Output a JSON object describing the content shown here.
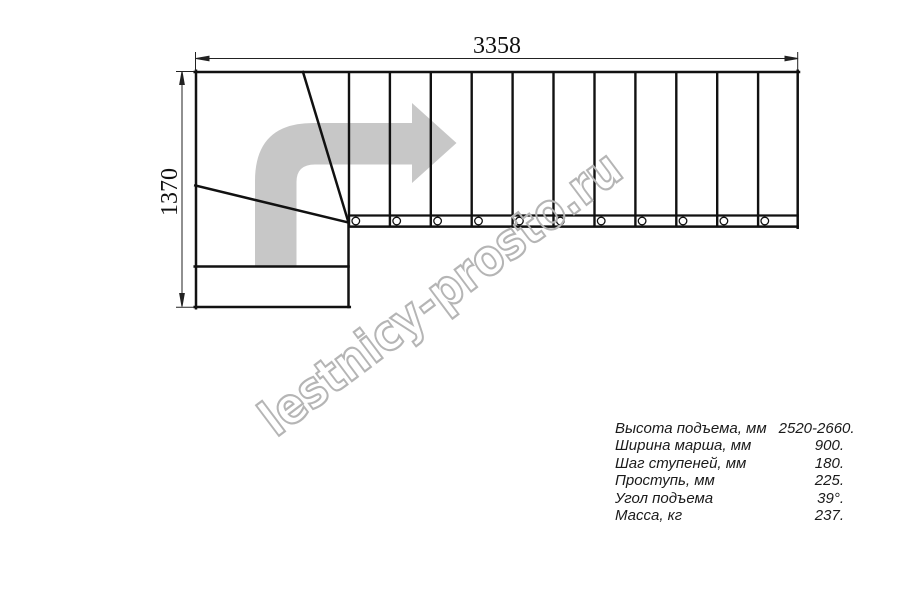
{
  "dimensions": {
    "width_label": "3358",
    "height_label": "1370"
  },
  "watermark": {
    "text": "lestnicy-prosto.ru"
  },
  "specs": {
    "rows": [
      {
        "label": "Высота подъема, мм",
        "value": "2520-2660."
      },
      {
        "label": "Ширина марша, мм",
        "value": "900."
      },
      {
        "label": "Шаг ступеней, мм",
        "value": "180."
      },
      {
        "label": "Проступь, мм",
        "value": "225."
      },
      {
        "label": "Угол подъема",
        "value": "39°."
      },
      {
        "label": "Масса, кг",
        "value": "237."
      }
    ]
  },
  "colors": {
    "line": "#111111",
    "dimension": "#222222",
    "arrow_fill": "#c7c7c7",
    "watermark": "#b5b5b5"
  }
}
